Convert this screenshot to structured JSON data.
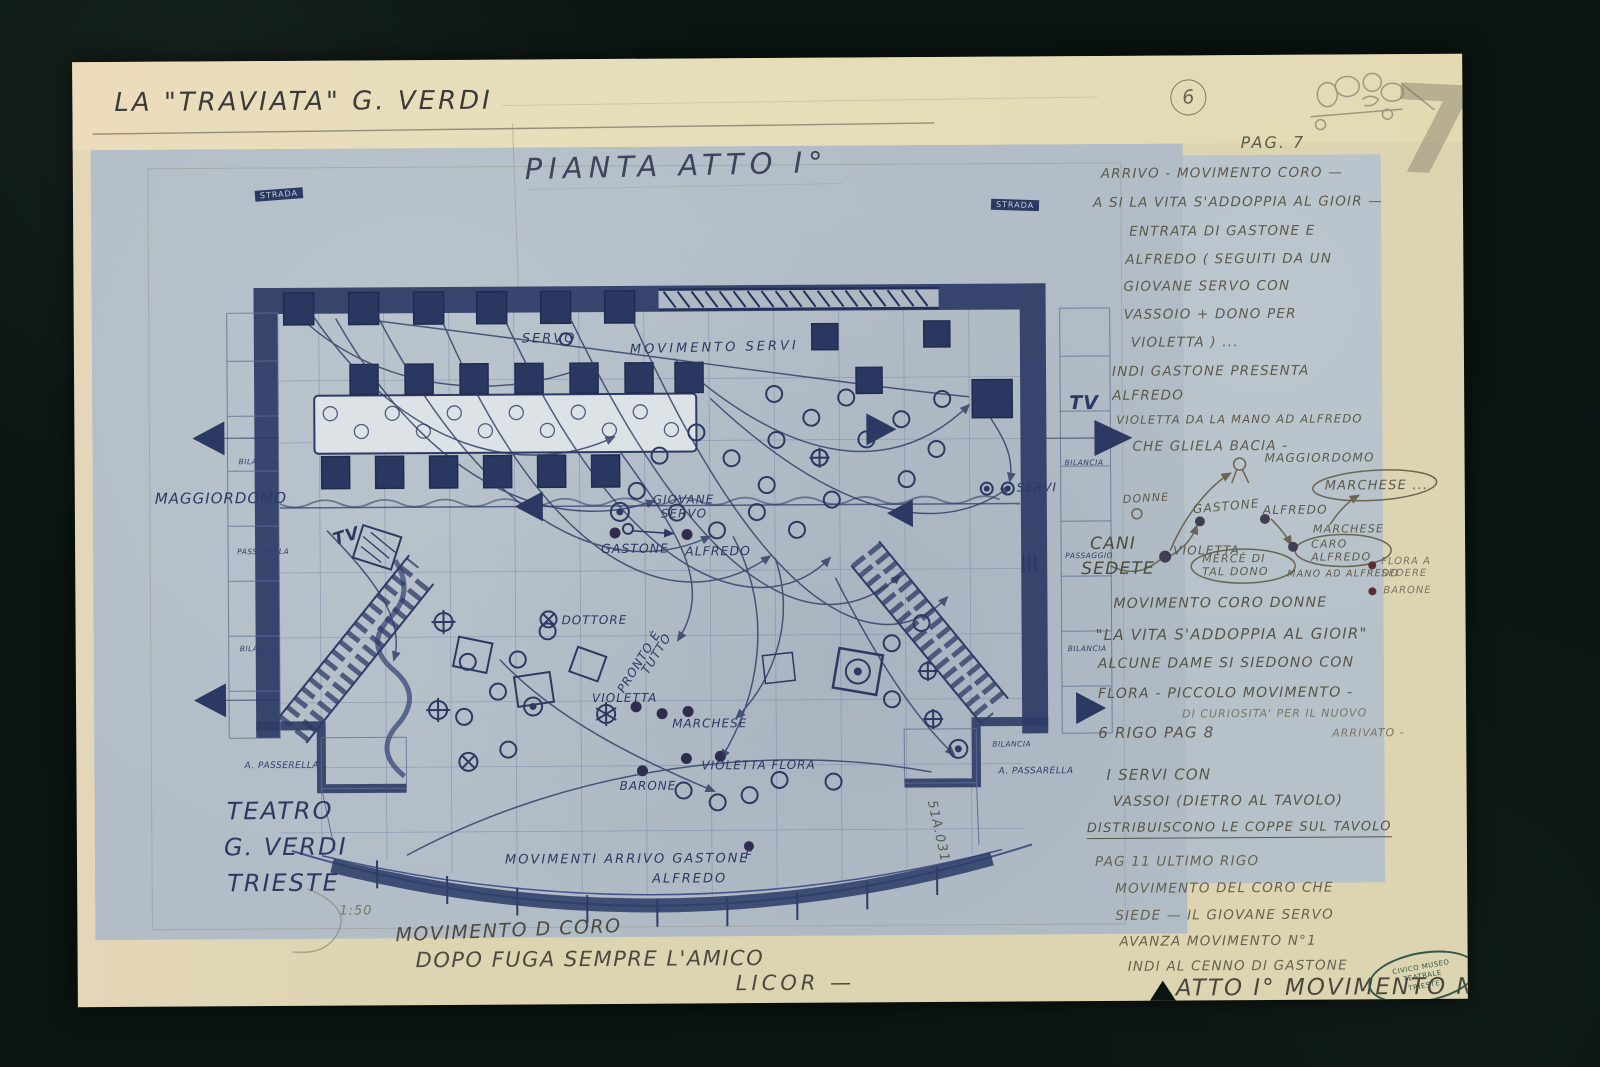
{
  "colors": {
    "background": "#0a1411",
    "paper_cream": "#ddd5b2",
    "print_blue": "#b2bdc7",
    "ink_navy": "#2c3a63",
    "pencil_grey": "#5d5a4b",
    "stamp_green": "#33584a",
    "red_mark": "#c13434"
  },
  "header": {
    "title": "LA \"TRAVIATA\"   G. VERDI",
    "plan_title": "PIANTA  ATTO I°",
    "page_circled": "6",
    "page_big": "7",
    "pag_label": "PAG. 7"
  },
  "notes_top": [
    "ARRIVO - MOVIMENTO CORO —",
    "A SI LA VITA S'ADDOPPIA AL GIOIR —",
    "ENTRATA  DI  GASTONE E",
    "ALFREDO ( SEGUITI  DA UN",
    "GIOVANE  SERVO  CON",
    "VASSOIO  +  DONO  PER",
    "VIOLETTA )  ...",
    "INDI  GASTONE  PRESENTA",
    "ALFREDO",
    "VIOLETTA DA LA MANO AD ALFREDO",
    "CHE  GLIELA  BACIA -"
  ],
  "mini_diagram": {
    "maggiordomo": "MAGGIORDOMO",
    "marchese_bubble": "MARCHESE ...",
    "donne": "DONNE",
    "gastone": "GASTONE",
    "alfredo": "ALFREDO",
    "marchese": "MARCHESE",
    "caro_alfredo": "CARO ALFREDO",
    "cani": "CANI",
    "sedete": "SEDETE",
    "violetta": "VIOLETTA",
    "merce_tal_dono": "MERCÉ DI TAL DONO",
    "mano_ad_alfredo": "MANO AD ALFREDO",
    "flora_a_sedere": "FLORA A SEDERE",
    "barone": "BARONE"
  },
  "notes_mid": [
    "MOVIMENTO CORO DONNE",
    "\"LA VITA S'ADDOPPIA AL GIOIR\"",
    "ALCUNE DAME SI SIEDONO CON",
    "FLORA - PICCOLO MOVIMENTO -",
    "DI CURIOSITA' PER IL NUOVO",
    "6 RIGO PAG 8",
    "ARRIVATO -"
  ],
  "notes_servi": [
    "I SERVI CON",
    "VASSOI (DIETRO AL TAVOLO)",
    "DISTRIBUISCONO LE COPPE SUL TAVOLO"
  ],
  "notes_pag11": [
    "PAG 11   ULTIMO RIGO",
    "MOVIMENTO DEL CORO CHE",
    "SIEDE — IL GIOVANE SERVO",
    "AVANZA   MOVIMENTO N°1",
    "INDI  AL CENNO DI GASTONE"
  ],
  "atto_line": "ATTO I° MOVIMENTO N°2",
  "plan_labels": {
    "strada_left": "STRADA",
    "strada_right": "STRADA",
    "servo": "SERVO",
    "movimento_servi": "MOVIMENTO  SERVI",
    "maggiordomo": "MAGGIORDOMO",
    "tv_left": "TV",
    "tv_right": "TV",
    "giovane": "GIOVANE",
    "servo2": "SERVO",
    "gastone": "GASTONE",
    "alfredo": "ALFREDO",
    "dottore": "DOTTORE",
    "pronto": "PRONTO È",
    "tutto": "TUTTO",
    "violetta": "VIOLETTA",
    "marchese": "MARCHESE",
    "violetta_flora": "VIOLETTA  FLORA",
    "barone": "BARONE",
    "f_mark": "F",
    "servi": "SERVI",
    "movimenti_arrivo": "MOVIMENTI  ARRIVO  GASTONE",
    "alfredo2": "ALFREDO",
    "bilancia_l1": "BILANCIA",
    "passarella_l": "PASSARELLA",
    "bilancia_l2": "BILANCIA",
    "a_passerella_l": "A. PASSERELLA",
    "bilancia_r1": "BILANCIA",
    "passaggio_r": "PASSAGGIO",
    "bilancia_r2": "BILANCIA",
    "bilancia_r3": "BILANCIA",
    "a_passarella_r": "A. PASSARELLA",
    "inventory": "51A.031"
  },
  "footer": {
    "teatro": "TEATRO",
    "gverdi": "G. VERDI",
    "trieste": "TRIESTE",
    "scale": "1:50",
    "mov1": "MOVIMENTO D CORO",
    "mov2": "DOPO  FUGA  SEMPRE  L'AMICO",
    "mov3": "LICOR —"
  },
  "stamp": {
    "l1": "CIVICO MUSEO",
    "l2": "TEATRALE",
    "l3": "TRIESTE"
  }
}
